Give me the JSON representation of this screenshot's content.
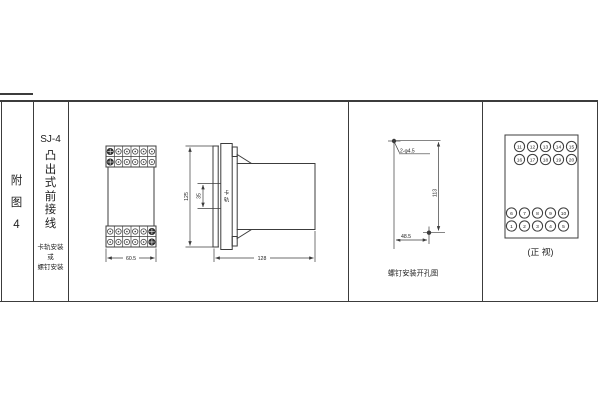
{
  "table": {
    "border_color": "#3c3c3c"
  },
  "index_column": {
    "chars": [
      "附",
      "图",
      "4"
    ]
  },
  "title_column": {
    "model": "SJ-4",
    "type_chars": [
      "凸",
      "出",
      "式",
      "前",
      "接",
      "线"
    ],
    "mount_lines": [
      "卡轨安装",
      "或",
      "螺钉安装"
    ]
  },
  "front_view": {
    "width_dim": "60.5"
  },
  "side_view": {
    "height_dim": "125",
    "rail_height_dim": "35",
    "rail_label_chars": [
      "卡",
      "轨"
    ],
    "depth_dim": "128"
  },
  "drill_view": {
    "holes_label": "2-φ4.5",
    "height_dim": "113",
    "width_dim": "48.5",
    "caption": "螺钉安装开孔图"
  },
  "terminal_view": {
    "caption": "(正 视)",
    "row_11_15": [
      "11",
      "12",
      "13",
      "14",
      "15"
    ],
    "row_16_20": [
      "16",
      "17",
      "18",
      "19",
      "20"
    ],
    "row_6_10": [
      "6",
      "7",
      "8",
      "9",
      "10"
    ],
    "row_1_5": [
      "1",
      "2",
      "3",
      "4",
      "5"
    ]
  }
}
